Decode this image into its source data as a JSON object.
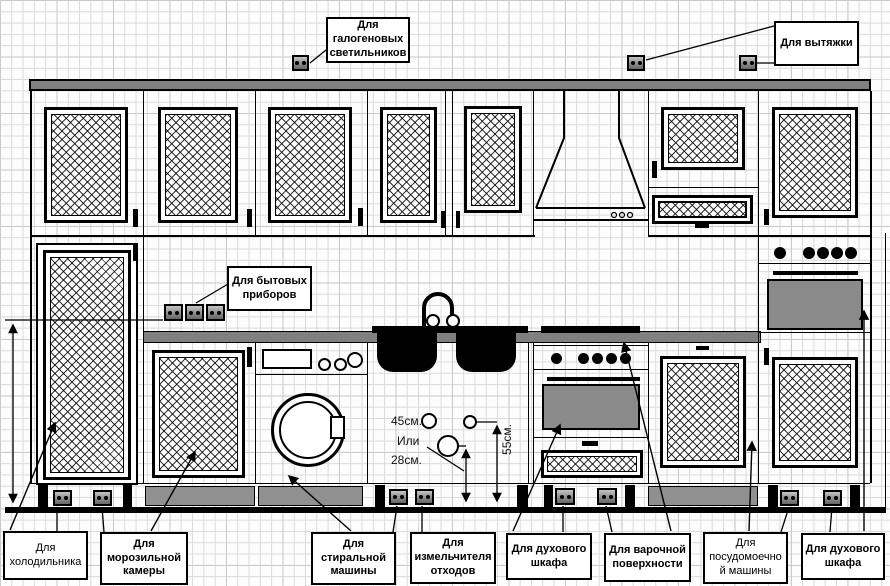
{
  "callouts": {
    "halogen": "Для\nгалогеновых\nсветильников",
    "hood": "Для вытяжки",
    "appliances": "Для бытовых\nприборов",
    "fridge": "Для\nхолодильника",
    "freezer": "Для\nморозильной\nкамеры",
    "washer": "Для\nстиральной\nмашины",
    "grinder": "Для\nизмельчителя\nотходов",
    "oven_left": "Для духового\nшкафа",
    "hob": "Для варочной\nповерхности",
    "dishwasher": "Для\nпосудомоечно\nй машины",
    "oven_right": "Для духового\nшкафа"
  },
  "dimensions": {
    "height_45": "45см.",
    "or_word": "Или",
    "height_28": "28см.",
    "height_55": "55см."
  },
  "icons": {
    "outlet": "power-outlet-icon",
    "arrow": "arrowhead-icon",
    "hood": "range-hood-icon",
    "faucet": "faucet-icon"
  },
  "colors": {
    "line": "#000000",
    "counter_gray": "#808080",
    "appliance_gray": "#8a8a8a",
    "plinth_gray": "#909090",
    "grid_minor": "#dadade",
    "grid_major": "#c9c9cf"
  }
}
